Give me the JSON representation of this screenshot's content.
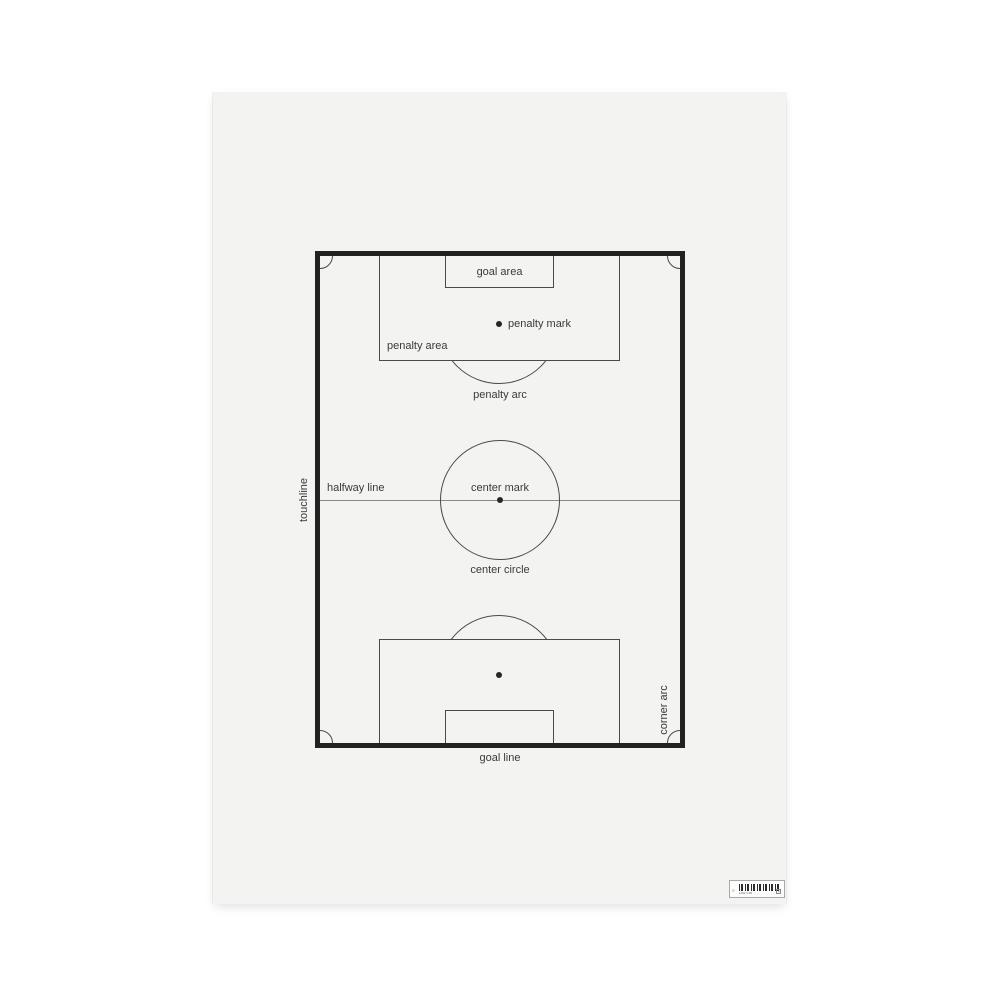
{
  "pitch_labels": {
    "goal_area": "goal area",
    "penalty_mark": "penalty mark",
    "penalty_area": "penalty area",
    "penalty_arc": "penalty arc",
    "touchline": "touchline",
    "halfway_line": "halfway line",
    "center_mark": "center mark",
    "center_circle": "center circle",
    "corner_arc": "corner arc",
    "goal_line": "goal line"
  },
  "barcode": {
    "caption": "LAW 1:00",
    "box_mark": "a"
  },
  "colors": {
    "page_bg": "#ffffff",
    "poster_bg": "#f3f3f2",
    "pitch_border": "#222222",
    "line": "#4a4a4a",
    "halfway_line": "#8a8a8a",
    "text": "#3a3a3a"
  }
}
